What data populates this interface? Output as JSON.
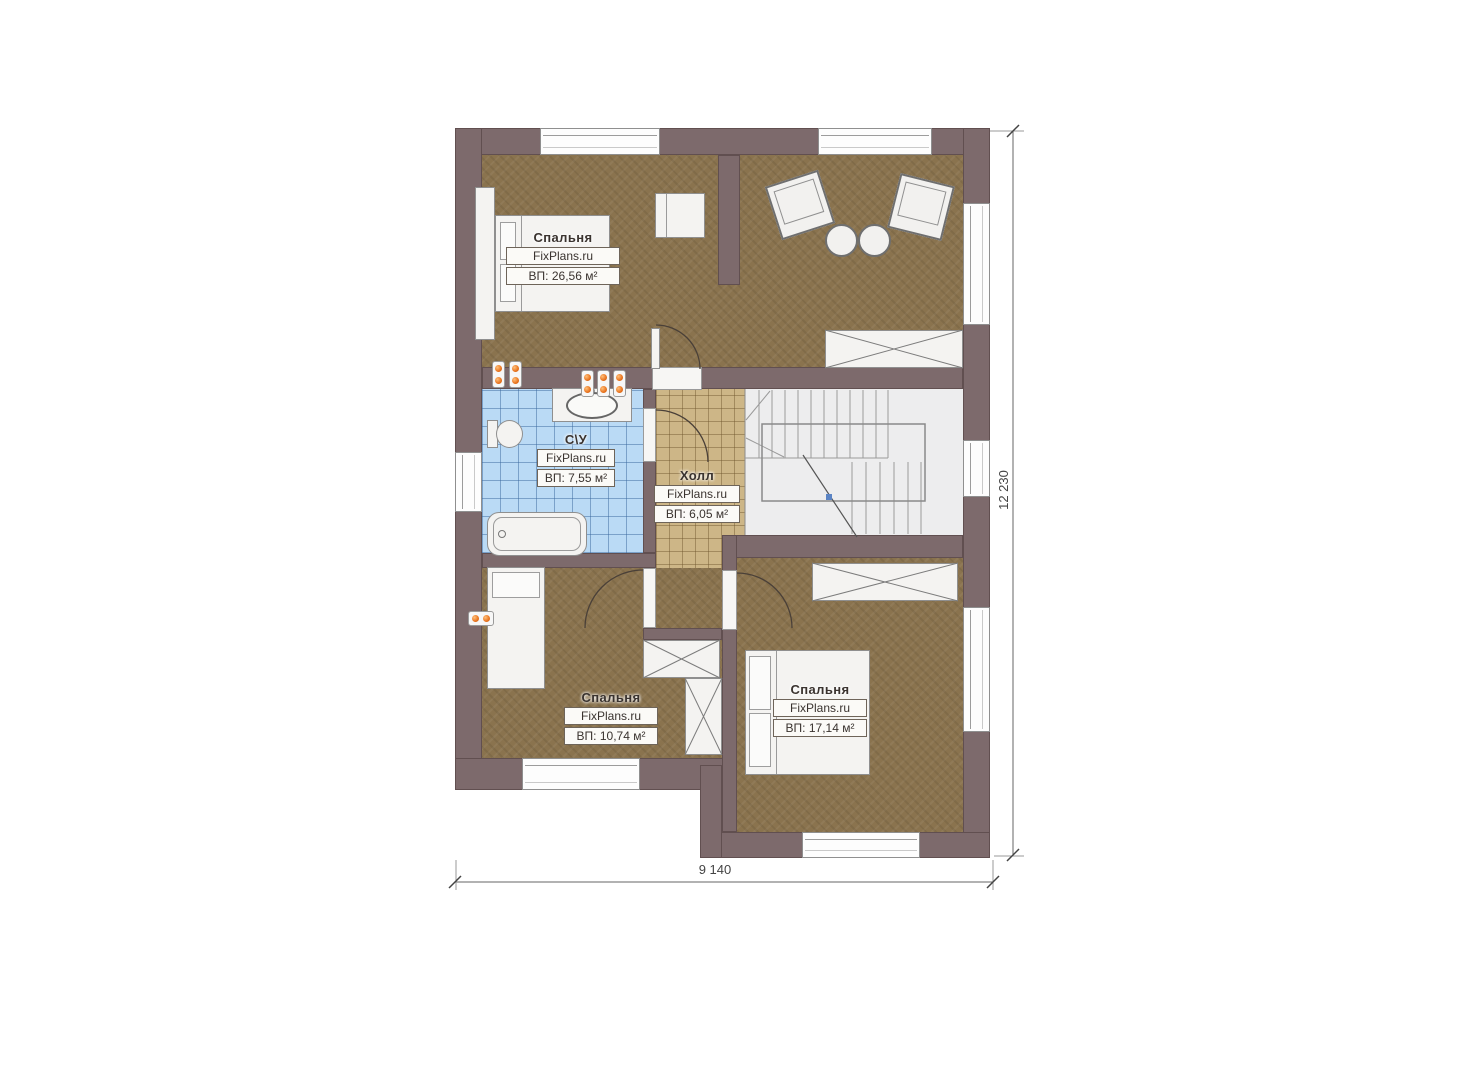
{
  "plan_title": "floor-plan",
  "rooms": [
    {
      "name": "Спальня",
      "brand": "FixPlans.ru",
      "area": "ВП: 26,56 м²"
    },
    {
      "name": "С\\У",
      "brand": "FixPlans.ru",
      "area": "ВП: 7,55 м²"
    },
    {
      "name": "Холл",
      "brand": "FixPlans.ru",
      "area": "ВП: 6,05 м²"
    },
    {
      "name": "Спальня",
      "brand": "FixPlans.ru",
      "area": "ВП: 10,74 м²"
    },
    {
      "name": "Спальня",
      "brand": "FixPlans.ru",
      "area": "ВП: 17,14 м²"
    }
  ],
  "dimensions": {
    "width_label": "9 140",
    "height_label": "12 230"
  },
  "colors": {
    "wall": "#7d6a6c",
    "wood_floor": "#8a734e",
    "bath_tile": "#badaf5",
    "hall_tile": "#cdb687",
    "socket_orange": "#e8731f"
  }
}
